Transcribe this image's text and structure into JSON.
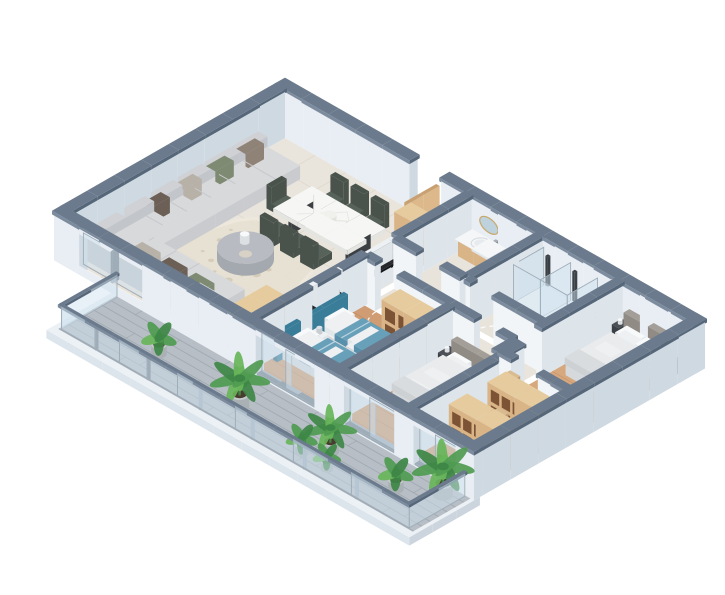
{
  "scene": {
    "description": "3D isometric rendering of an apartment floor plan with open living-dining-kitchen, entrance hall, two bathrooms, kids bedroom, bedroom, master bedroom, walk-in closet and front balcony with potted plants",
    "projection": "isometric",
    "background": "#ffffff",
    "rooms": [
      {
        "name": "living-dining-kitchen",
        "floor": "cream-tile",
        "furniture": [
          "l-shaped-sectional-sofa",
          "throw-pillows",
          "round-coffee-table",
          "shag-rug",
          "marble-dining-table",
          "dining-chairs-x7",
          "galley-kitchen-counter",
          "black-countertop",
          "sink",
          "hob",
          "coffee-machine",
          "tall-wood-cabinet",
          "entrance-door"
        ]
      },
      {
        "name": "guest-bathroom",
        "floor": "tile",
        "furniture": [
          "wood-vanity-with-sink",
          "oval-mirror",
          "toilet"
        ]
      },
      {
        "name": "main-bathroom",
        "floor": "tile",
        "furniture": [
          "glass-shower-cabin-x2",
          "wood-vanity-with-sink",
          "toilet"
        ]
      },
      {
        "name": "hallway",
        "floor": "tile",
        "furniture": [
          "door-swing-arcs"
        ]
      },
      {
        "name": "kids-bedroom",
        "floor": "wood",
        "furniture": [
          "single-bed-x2",
          "teal-blankets",
          "teal-padded-headboard-wall",
          "nightstand",
          "open-wardrobe-cubbies"
        ]
      },
      {
        "name": "bedroom",
        "floor": "wood",
        "furniture": [
          "double-bed",
          "gray-headboard",
          "dark-nightstand"
        ]
      },
      {
        "name": "master-bedroom",
        "floor": "wood",
        "furniture": [
          "double-bed",
          "upholstered-headboard",
          "dark-nightstand-x2",
          "dark-dresser"
        ]
      },
      {
        "name": "walk-in-closet",
        "floor": "wood",
        "furniture": [
          "open-shelf-row-x2"
        ]
      },
      {
        "name": "balcony",
        "floor": "gray-wood-planks",
        "furniture": [
          "glass-railing",
          "potted-plant-x7",
          "sliding-glass-door-x3"
        ]
      }
    ],
    "plants_count": 7
  },
  "palette": {
    "bg": "#ffffff",
    "cap_top": "#6b7b8d",
    "cap_front": "#7c8c9e",
    "cap_side": "#57677a",
    "wall_face": "#f2f5f7",
    "wall_side": "#dde4ea",
    "ext_face": "#e8eef3",
    "ext_side": "#cfd9e1",
    "tile": "#eae5dc",
    "tile_bath": "#e8e4db",
    "tile_line": "#d8d1c4",
    "wood": "#cf9c73",
    "wood_light": "#d7a77d",
    "wood_line": "#a06a44",
    "balcony_floor": "#b7bec5",
    "balcony_line": "#8d969e",
    "slab_top": "#ecf1f6",
    "slab_front": "#dce4ec",
    "slab_side": "#ccd5de",
    "glass": "#cfe2ee",
    "frame": "#9fadb9",
    "sofa_seat": "#d8d9db",
    "sofa_front": "#c9cbcf",
    "sofa_back_top": "#cfd1d4",
    "sofa_back_side": "#c2c5c9",
    "pillow_brown": "#8f8276",
    "pillow_green": "#7e8a71",
    "pillow_beige": "#b7b1a8",
    "pillow_dark": "#6c6056",
    "pillow_white": "#f7f9fa",
    "rug": "#e7e1d4",
    "rug_edge": "#efe9dd",
    "rug_dot": "#d6ccba",
    "table_top": "#f6f6f4",
    "table_side": "#e4e4e1",
    "leg_dark": "#3c4043",
    "vein": "#dcdcd7",
    "chair": "#57625a",
    "chair_dark": "#49534c",
    "counter_top": "#26282c",
    "counter_side": "#17181b",
    "cab_white": "#eef1f3",
    "cab_white_shade": "#dfe5e9",
    "cab_wood": "#d9b487",
    "cab_wood_side": "#c49f72",
    "cab_wood_top": "#e6cb9e",
    "shelf_interior": "#7c5435",
    "fix_white": "#f4f6f7",
    "fix_shade": "#e2e7ea",
    "mirror": "#bdd2dd",
    "brass": "#c9a86c",
    "door": "#dcb88a",
    "door_shade": "#c9a072",
    "bed_base": "#eef0f2",
    "bed_side": "#d6d9dc",
    "duvet": "#e9ebec",
    "duvet_shade": "#d9dcde",
    "duvet_fold": "#cdd1d4",
    "headboard": "#a39e97",
    "headboard_side": "#908b84",
    "teal_blanket": "#68a0ba",
    "teal_shade": "#5890ab",
    "teal_wall": "#3a7d99",
    "teal_wall_side": "#2f6b85",
    "dark_furn": "#3b4046",
    "dark_furn_top": "#4a5056",
    "pot": "#c4c9cc",
    "pot_side": "#aab1b5",
    "soil": "#4a3b2e",
    "green_1": "#4f9b51",
    "green_2": "#3e8746",
    "green_3": "#68b55a",
    "arc_white": "#ffffff",
    "hob": "#1b1d20",
    "burner": "#3a3f44",
    "steel": "#a7adb2",
    "steel_dark": "#878e94",
    "appliance": "#31353a",
    "appliance_top": "#3d4247",
    "wood_board": "#c89a6d",
    "handle": "#b08a5e",
    "lamp": "#c8cdd2"
  }
}
